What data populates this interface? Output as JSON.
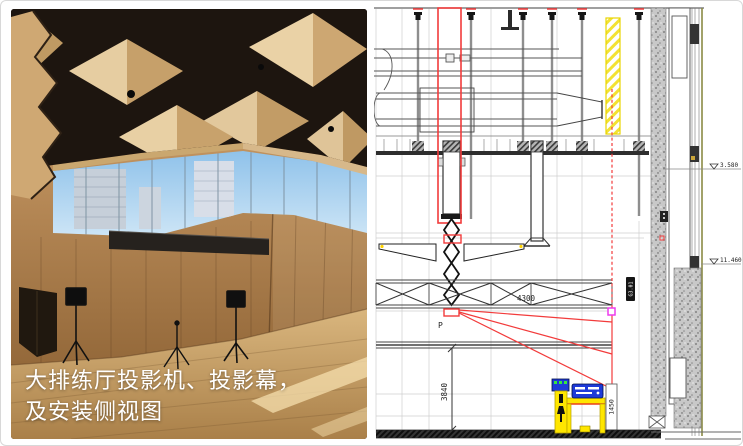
{
  "caption": {
    "line1": "大排练厅投影机、投影幕，",
    "line2": "及安装侧视图"
  },
  "drawing": {
    "projector_label": "P",
    "dim_ceiling_height": "3840",
    "dim_truss_span": "4300",
    "dim_screen_drop": "1450",
    "elevation_upper": "3.580",
    "elevation_lower": "11.460",
    "equipment_badge": "G3.01",
    "colors": {
      "beam_red": "#f23b3b",
      "highlight_yellow": "#e8d400",
      "screen_magenta": "#ee3cee",
      "equipment_blue": "#1e3ad8",
      "stand_yellow": "#ffe600"
    }
  }
}
